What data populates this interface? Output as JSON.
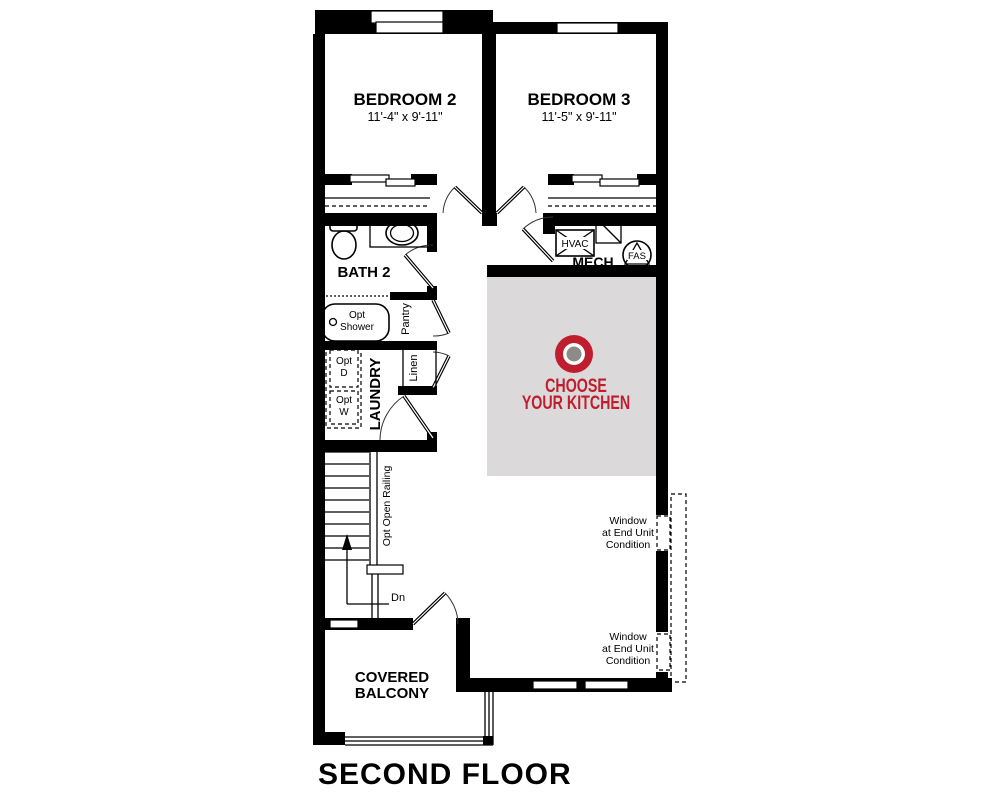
{
  "title": "SECOND FLOOR",
  "colors": {
    "accent_red": "#bf1e2e",
    "kitchen_fill": "#dcd9da",
    "target_gray": "#8c8c86"
  },
  "rooms": {
    "bedroom2": {
      "name": "BEDROOM 2",
      "dims": "11'-4\" x 9'-11\""
    },
    "bedroom3": {
      "name": "BEDROOM 3",
      "dims": "11'-5\" x 9'-11\""
    },
    "bath2": {
      "name": "BATH 2"
    },
    "laundry": {
      "name": "LAUNDRY"
    },
    "pantry": {
      "name": "Pantry"
    },
    "linen": {
      "name": "Linen"
    },
    "mech": {
      "name": "MECH"
    },
    "balcony": {
      "line1": "COVERED",
      "line2": "BALCONY"
    }
  },
  "labels": {
    "hvac": "HVAC",
    "fas": "FAS",
    "opt_shower": {
      "line1": "Opt",
      "line2": "Shower"
    },
    "opt_dryer": {
      "line1": "Opt",
      "line2": "D"
    },
    "opt_washer": {
      "line1": "Opt",
      "line2": "W"
    },
    "opt_open_railing": "Opt Open Railing",
    "down": "Dn"
  },
  "kitchen_cta": {
    "line1": "CHOOSE",
    "line2": "YOUR KITCHEN"
  },
  "window_note": {
    "line1": "Window",
    "line2": "at End Unit",
    "line3": "Condition"
  }
}
